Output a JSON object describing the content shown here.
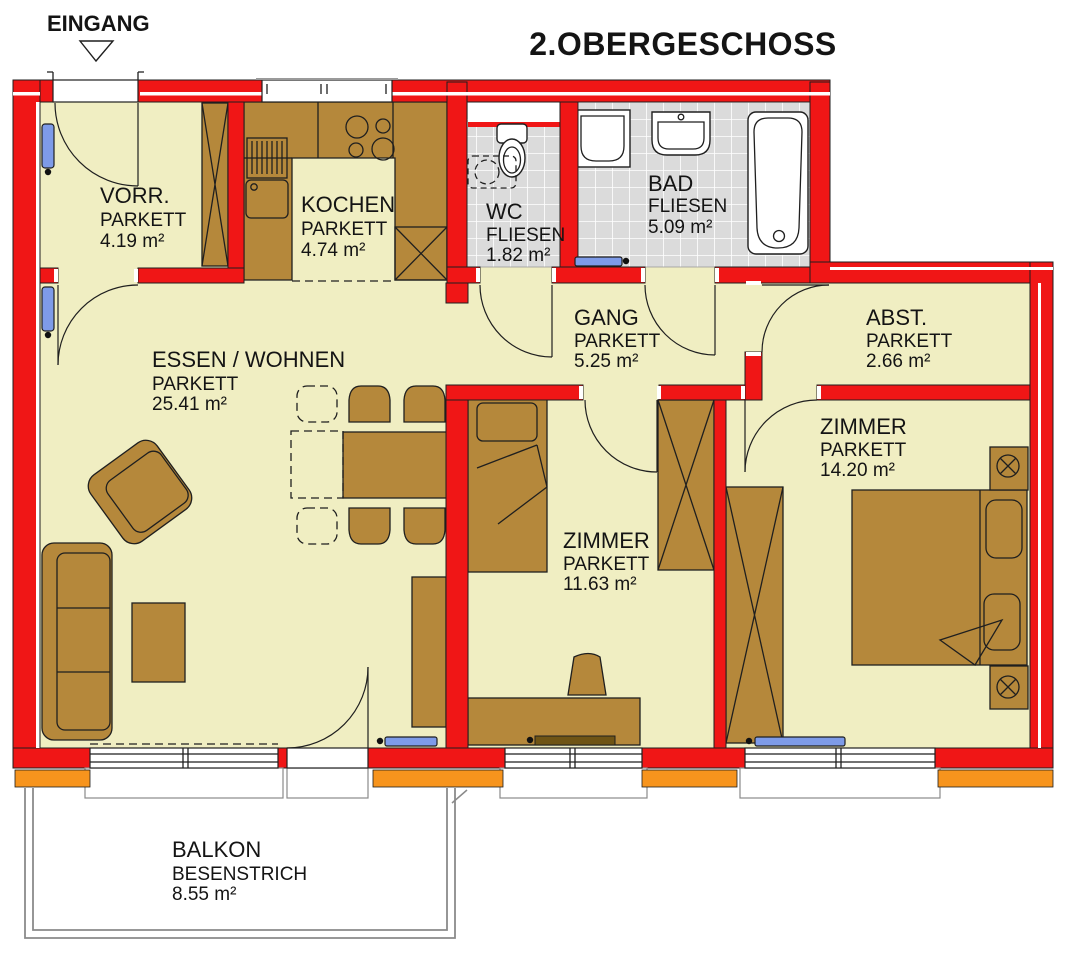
{
  "title": "2.OBERGESCHOSS",
  "entrance_label": "EINGANG",
  "rooms": [
    {
      "name": "VORR.",
      "floor": "PARKETT",
      "area": "4.19 m²"
    },
    {
      "name": "KOCHEN",
      "floor": "PARKETT",
      "area": "4.74 m²"
    },
    {
      "name": "WC",
      "floor": "FLIESEN",
      "area": "1.82 m²"
    },
    {
      "name": "BAD",
      "floor": "FLIESEN",
      "area": "5.09 m²"
    },
    {
      "name": "GANG",
      "floor": "PARKETT",
      "area": "5.25 m²"
    },
    {
      "name": "ABST.",
      "floor": "PARKETT",
      "area": "2.66 m²"
    },
    {
      "name": "ESSEN / WOHNEN",
      "floor": "PARKETT",
      "area": "25.41 m²"
    },
    {
      "name": "ZIMMER",
      "floor": "PARKETT",
      "area": "11.63 m²"
    },
    {
      "name": "ZIMMER",
      "floor": "PARKETT",
      "area": "14.20 m²"
    },
    {
      "name": "BALKON",
      "floor": "BESENSTRICH",
      "area": "8.55 m²"
    }
  ],
  "colors": {
    "wall_red": "#F01616",
    "floor_parquet": "#F0EEC2",
    "floor_tile": "#DBDBDB",
    "furniture_brown": "#B5883B",
    "radiator_blue": "#7E9BE8",
    "window_sill_orange": "#F7941D",
    "fixture_white": "#FFFFFF",
    "line_black": "#1F1F1F"
  }
}
